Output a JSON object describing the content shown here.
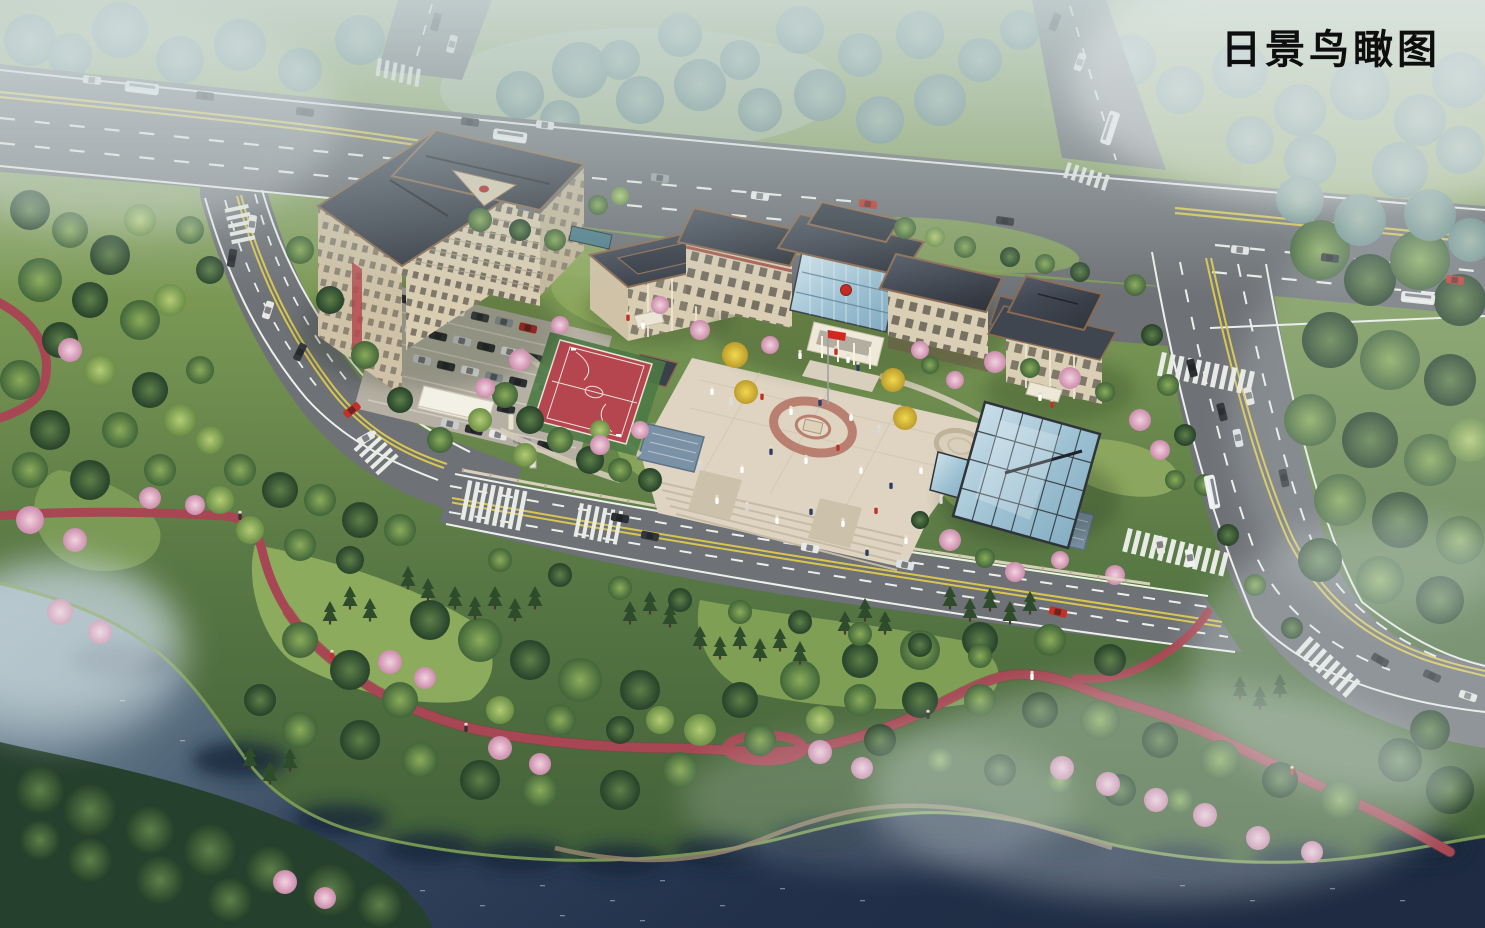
{
  "title": "日景鸟瞰图",
  "scene": {
    "description": "Daytime aerial bird's-eye architectural rendering: a campus of Chinese-roofed buildings with central plaza, glass conservatory, basketball court and parking lot, bounded by a highway and side roads, with a riverside park, pink blossoms and red jogging paths below",
    "landmarks": [
      "main-highway",
      "north-branch-road",
      "northeast-branch-road",
      "east-road",
      "south-road",
      "west-road",
      "dormitory-building",
      "library-building",
      "main-building",
      "east-annex-building",
      "glass-conservatory",
      "central-plaza",
      "basketball-court",
      "parking-lot",
      "campus-entrance-gate",
      "jogging-path",
      "riverside-park",
      "river"
    ]
  },
  "palette": {
    "haze": "#aebfc6",
    "forest_green": "#4a6b3a",
    "lawn_green": "#8aa862",
    "asphalt": "#6e7175",
    "marking_white": "#eef0ec",
    "marking_yellow": "#d9c64f",
    "roof_slate": "#3b414b",
    "roof_trim": "#8a6a50",
    "wall_beige": "#d8ccb2",
    "glass_blue": "#aecbdb",
    "court_red": "#b5464f",
    "plaza_paving": "#ddd3c0",
    "plaza_ring": "#b97f70",
    "path_red": "#a64753",
    "blossom_pink": "#e5b5cb",
    "ginkgo_yellow": "#e2c73e",
    "water_dark": "#243450",
    "water_light": "#93aab4",
    "flag_red": "#d42620"
  }
}
